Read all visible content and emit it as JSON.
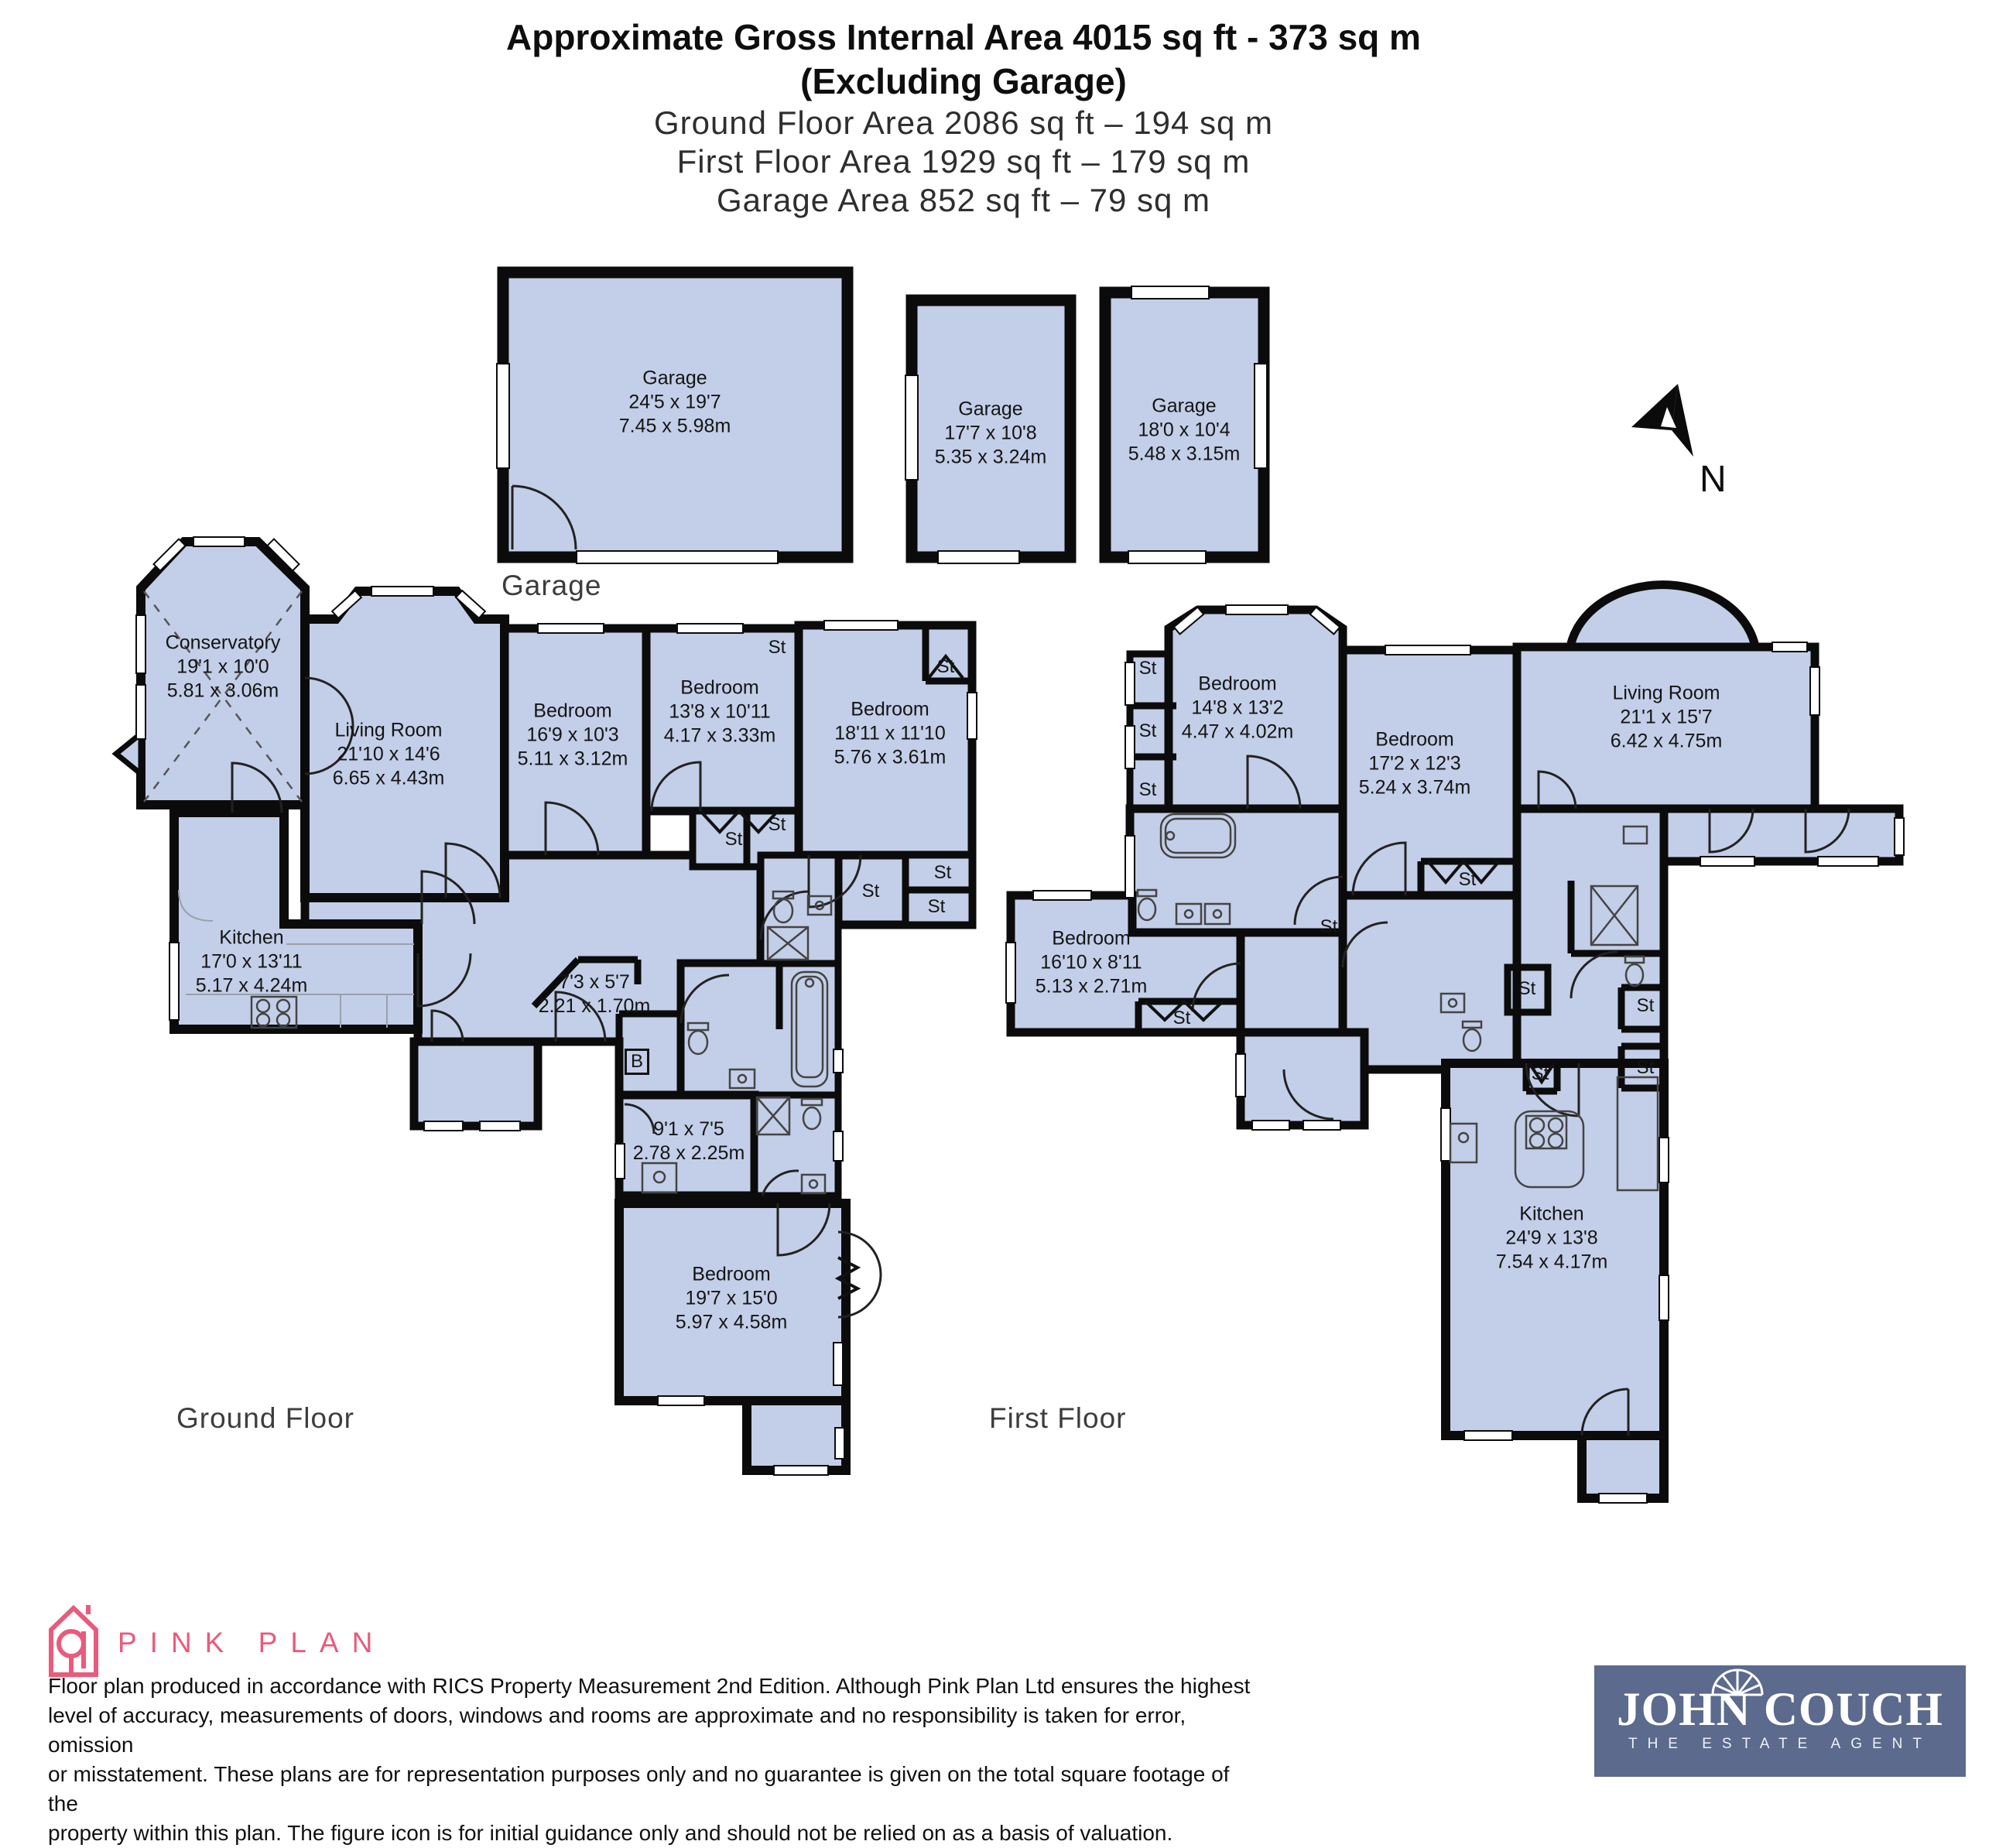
{
  "header": {
    "title1": "Approximate Gross Internal Area 4015 sq ft - 373 sq m",
    "title2": "(Excluding Garage)",
    "area_lines": [
      "Ground Floor Area 2086 sq ft – 194 sq m",
      "First Floor Area 1929 sq ft – 179 sq m",
      "Garage Area 852 sq ft – 79 sq m"
    ]
  },
  "captions": {
    "garage": "Garage",
    "ground": "Ground Floor",
    "first": "First Floor",
    "north": "N"
  },
  "labels": {
    "st": "St",
    "b": "B"
  },
  "garages": [
    {
      "name": "Garage",
      "ft": "24'5 x 19'7",
      "m": "7.45 x 5.98m"
    },
    {
      "name": "Garage",
      "ft": "17'7 x 10'8",
      "m": "5.35 x 3.24m"
    },
    {
      "name": "Garage",
      "ft": "18'0 x 10'4",
      "m": "5.48 x 3.15m"
    }
  ],
  "ground_rooms": [
    {
      "name": "Conservatory",
      "ft": "19'1 x 10'0",
      "m": "5.81 x 3.06m"
    },
    {
      "name": "Living Room",
      "ft": "21'10 x 14'6",
      "m": "6.65 x 4.43m"
    },
    {
      "name": "Bedroom",
      "ft": "16'9 x 10'3",
      "m": "5.11 x 3.12m"
    },
    {
      "name": "Bedroom",
      "ft": "13'8 x 10'11",
      "m": "4.17 x 3.33m"
    },
    {
      "name": "Bedroom",
      "ft": "18'11 x 11'10",
      "m": "5.76 x 3.61m"
    },
    {
      "name": "Kitchen",
      "ft": "17'0 x 13'11",
      "m": "5.17 x 4.24m"
    },
    {
      "name": "",
      "ft": "7'3 x 5'7",
      "m": "2.21 x 1.70m"
    },
    {
      "name": "",
      "ft": "9'1 x 7'5",
      "m": "2.78 x 2.25m"
    },
    {
      "name": "Bedroom",
      "ft": "19'7 x 15'0",
      "m": "5.97 x 4.58m"
    }
  ],
  "first_rooms": [
    {
      "name": "Bedroom",
      "ft": "14'8 x 13'2",
      "m": "4.47 x 4.02m"
    },
    {
      "name": "Bedroom",
      "ft": "17'2 x 12'3",
      "m": "5.24 x 3.74m"
    },
    {
      "name": "Living Room",
      "ft": "21'1 x 15'7",
      "m": "6.42 x 4.75m"
    },
    {
      "name": "Bedroom",
      "ft": "16'10 x 8'11",
      "m": "5.13 x 2.71m"
    },
    {
      "name": "Kitchen",
      "ft": "24'9 x 13'8",
      "m": "7.54 x 4.17m"
    }
  ],
  "footer": {
    "brand": "PINK PLAN",
    "disclaimer": [
      "Floor plan produced in accordance with RICS Property Measurement 2nd Edition. Although Pink Plan Ltd ensures the highest",
      "level of accuracy, measurements of doors, windows and rooms are approximate and no responsibility is taken for error, omission",
      "or misstatement. These plans are for representation purposes only and no guarantee is given on the total square footage of the",
      "property within this plan. The figure icon is for initial guidance only and should not be relied on as a basis of valuation."
    ],
    "agent_name": "JOHN COUCH",
    "agent_tagline": "THE ESTATE AGENT"
  },
  "colors": {
    "floor_fill": "#c3cfe8",
    "wall": "#0b0b0b",
    "pink": "#e85b7c",
    "agent_bg": "#5b6a8d"
  }
}
